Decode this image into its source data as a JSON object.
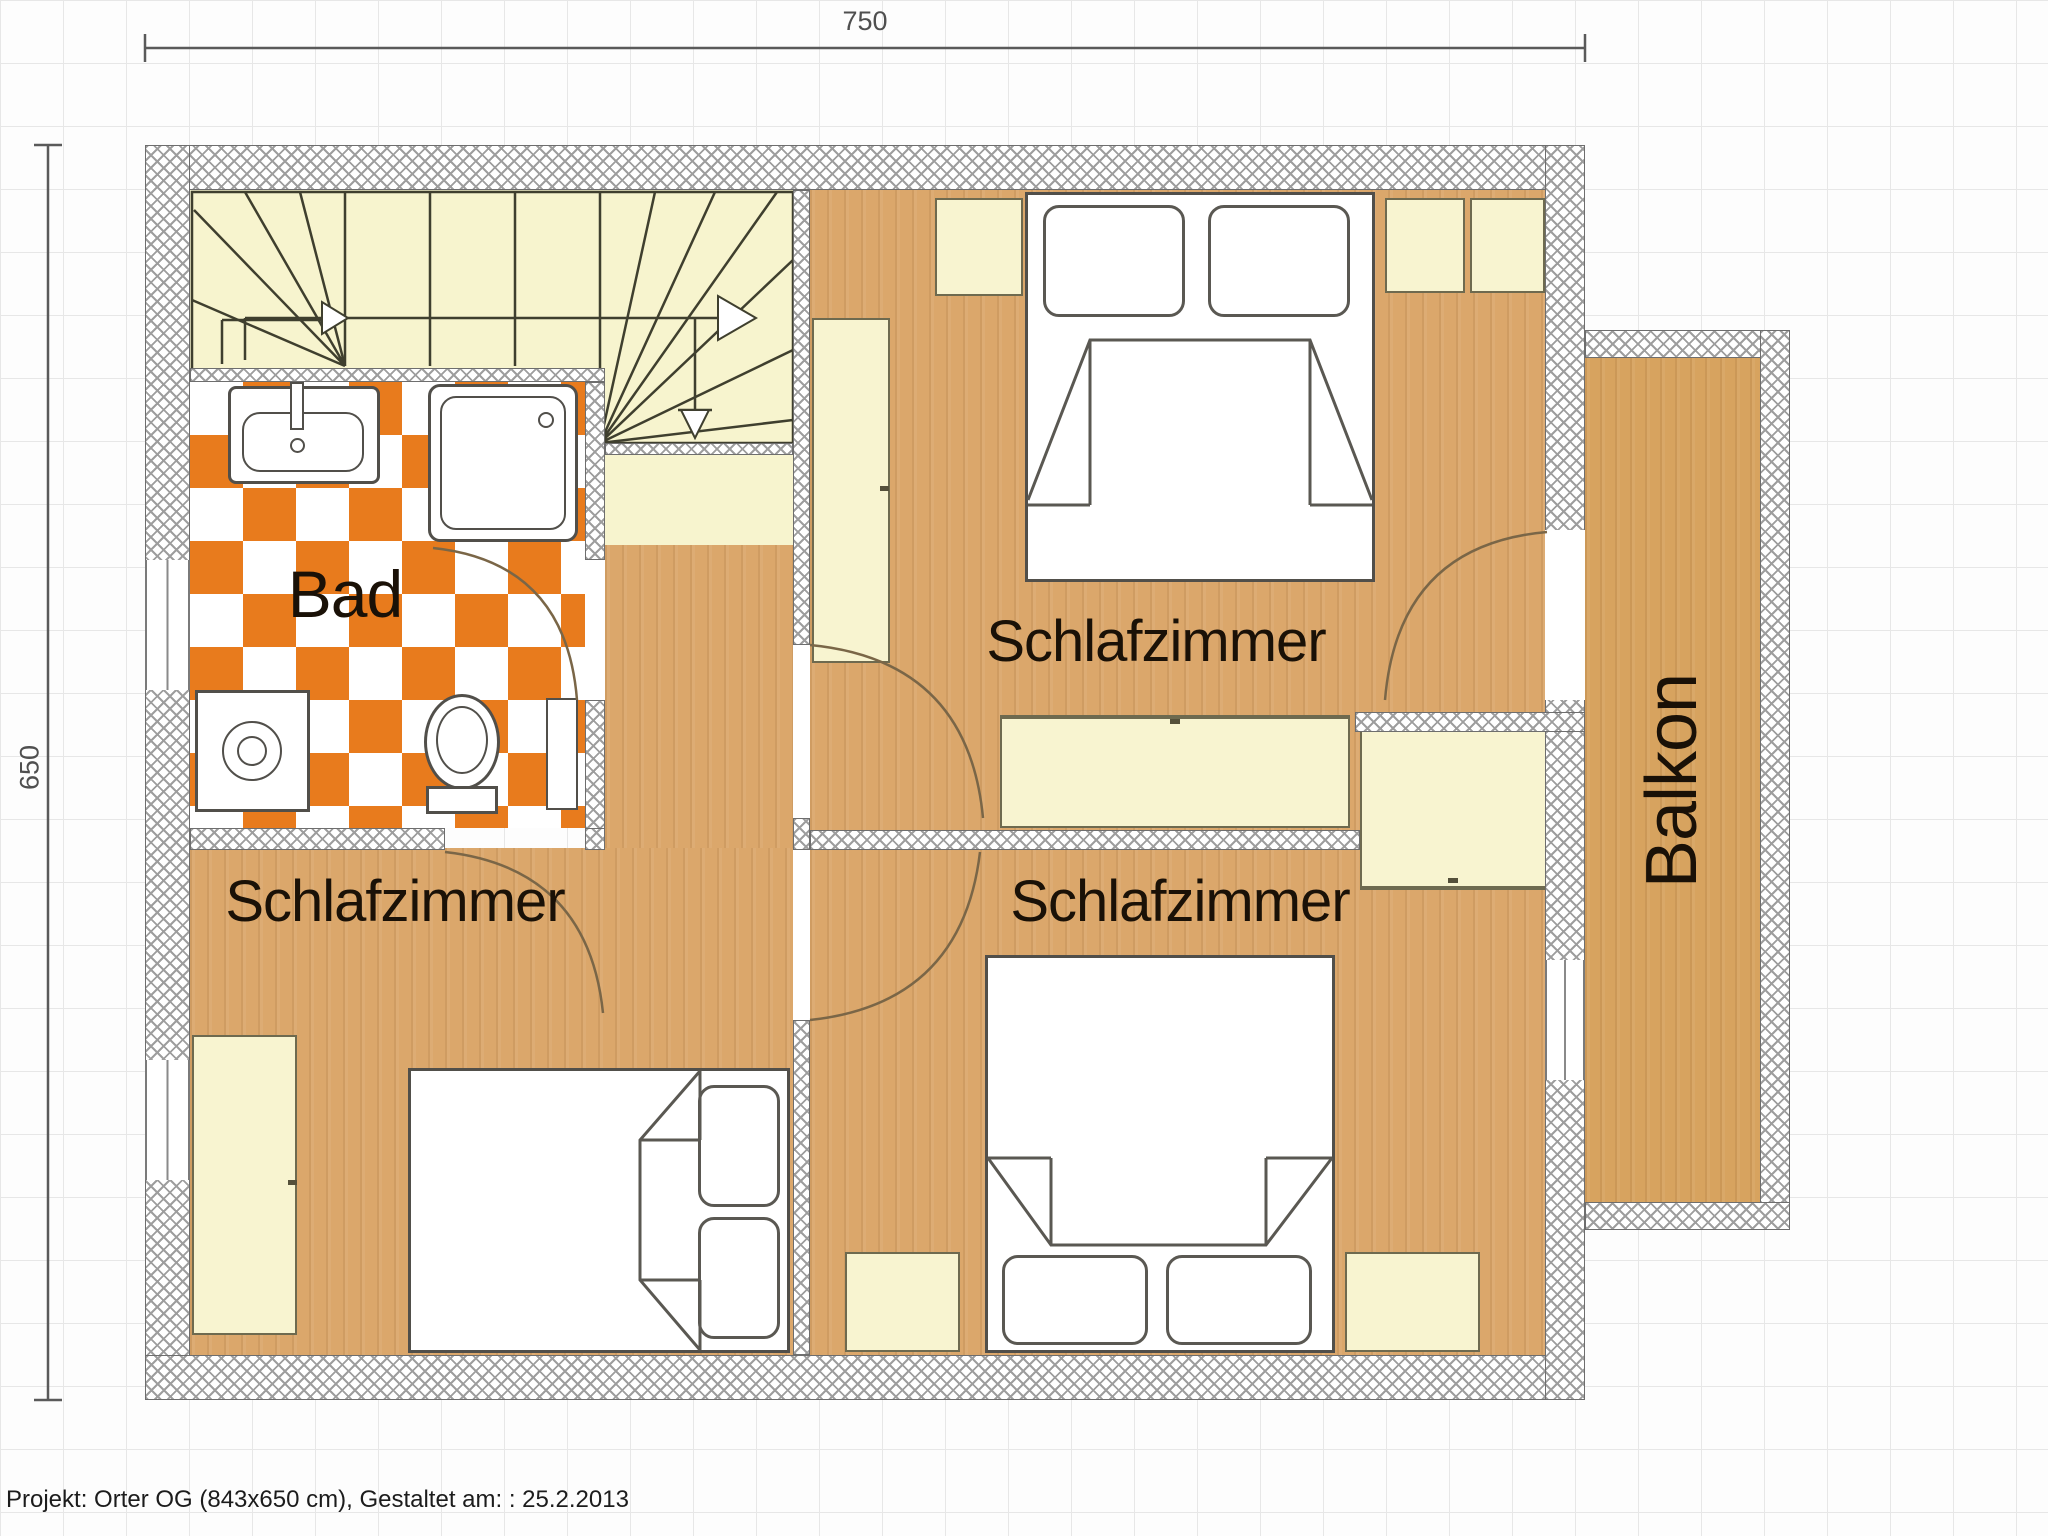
{
  "dimensions": {
    "top_cm": "750",
    "left_cm": "650"
  },
  "rooms": {
    "bath": "Bad",
    "bedroom_top_right": "Schlafzimmer",
    "bedroom_bottom_left": "Schlafzimmer",
    "bedroom_bottom_right": "Schlafzimmer",
    "balcony": "Balkon"
  },
  "footer": {
    "project_line": "Projekt: Orter OG (843x650 cm), Gestaltet am: : 25.2.2013"
  },
  "colors": {
    "tile_orange": "#E87B1D",
    "wood_floor": "#DBA76B",
    "balcony_wood": "#D7A35F",
    "furniture_cream": "#F8F4D0",
    "stair_cream": "#F7F4CE",
    "wall_hatch_gray": "#9E9E9E",
    "grid_gray": "#E7E7E7"
  }
}
